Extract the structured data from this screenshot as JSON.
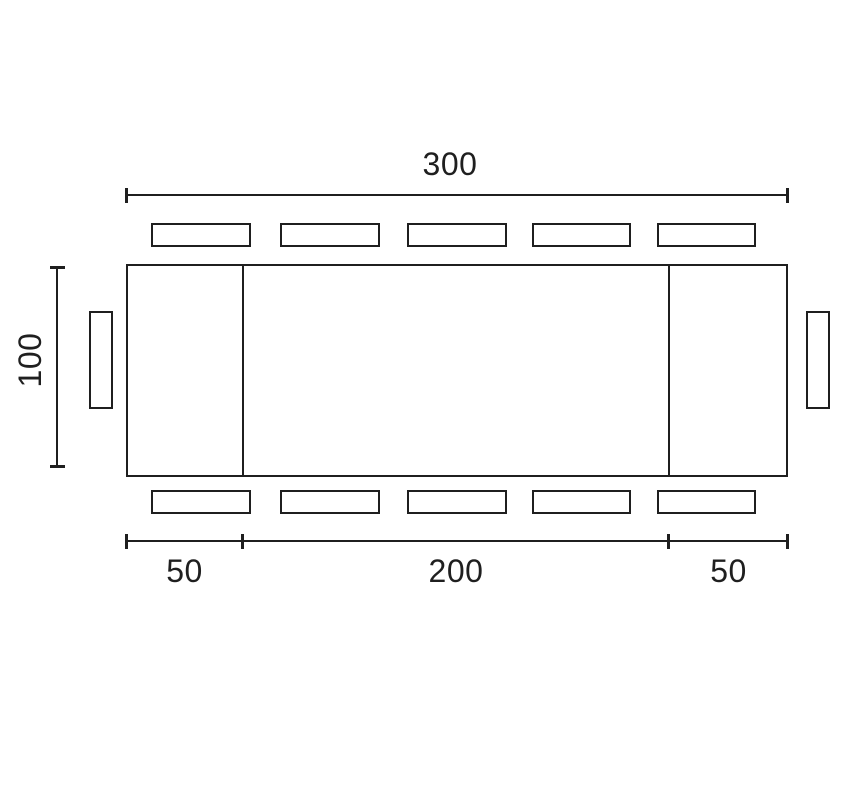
{
  "diagram": {
    "title": "extendable-table-seating-plan",
    "dimensions": {
      "total_length": "300",
      "depth": "100",
      "left_leaf": "50",
      "center_section": "200",
      "right_leaf": "50"
    },
    "seats": {
      "top": 5,
      "bottom": 5,
      "left": 1,
      "right": 1,
      "total": 12
    },
    "colors": {
      "line": "#1f1f1f",
      "background": "#ffffff"
    }
  }
}
